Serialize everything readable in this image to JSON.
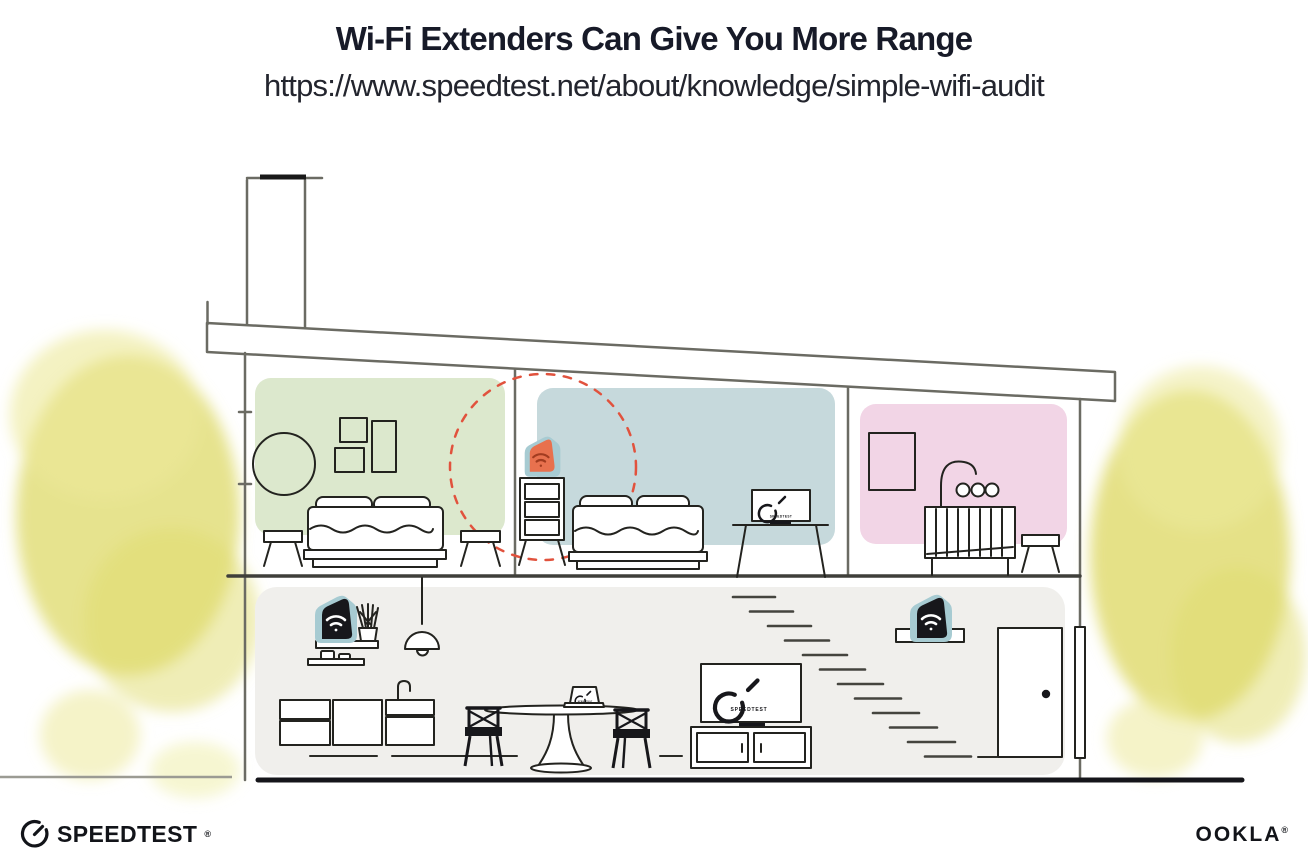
{
  "header": {
    "title": "Wi-Fi Extenders Can Give You More Range",
    "url": "https://www.speedtest.net/about/knowledge/simple-wifi-audit"
  },
  "branding": {
    "speedtest_wordmark": "SPEEDTEST",
    "speedtest_trademark": "®",
    "ookla_wordmark": "OOKLA",
    "ookla_trademark": "®"
  },
  "illustration": {
    "living_room_tv_label": "SPEEDTEST",
    "bedroom_tv_label": "SPEEDTEST",
    "laptop_label": "SPEEDTEST",
    "colors": {
      "bedroom_green": "#dce8cd",
      "bedroom_blue": "#c6d9dc",
      "nursery_pink": "#f2d5e6",
      "downstairs_gray": "#f0efec",
      "extender_teal": "#a7cbd2",
      "extender_orange": "#e8714e",
      "extender_orange_icon": "#a23c20",
      "device_black": "#17171b",
      "wifi_white": "#ffffff",
      "range_dash_red": "#e1523d",
      "foliage_yellow": "#dfdb6e",
      "foliage_yellow_light": "#ecea9a",
      "wall_gray": "#6b6b63",
      "ink": "#23231f"
    }
  }
}
